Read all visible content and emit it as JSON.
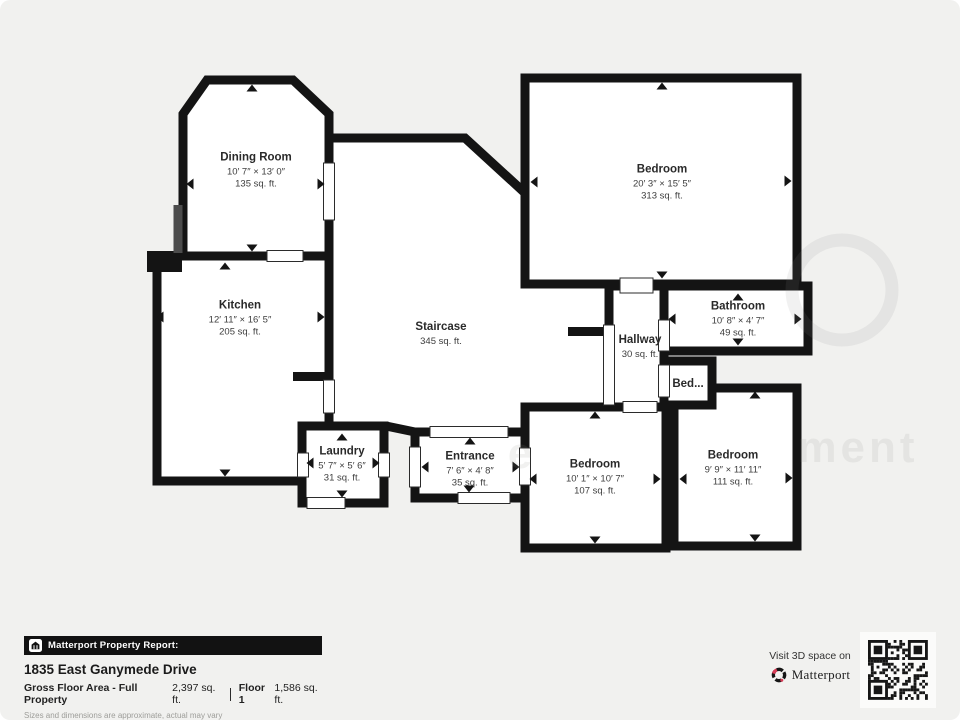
{
  "page": {
    "type": "floor-plan-report",
    "background": "#f1f1ef",
    "wall_color": "#141414",
    "brand_red": "#d63b55"
  },
  "rooms": [
    {
      "id": "dining-room",
      "name": "Dining Room",
      "dimensions": "10′ 7″ × 13′ 0″",
      "area": "135 sq. ft."
    },
    {
      "id": "kitchen",
      "name": "Kitchen",
      "dimensions": "12′ 11″ × 16′ 5″",
      "area": "205 sq. ft."
    },
    {
      "id": "staircase",
      "name": "Staircase",
      "dimensions": "",
      "area": "345 sq. ft."
    },
    {
      "id": "bedroom-master",
      "name": "Bedroom",
      "dimensions": "20′ 3″ × 15′ 5″",
      "area": "313 sq. ft."
    },
    {
      "id": "bathroom",
      "name": "Bathroom",
      "dimensions": "10′ 8″ × 4′ 7″",
      "area": "49 sq. ft."
    },
    {
      "id": "hallway",
      "name": "Hallway",
      "dimensions": "",
      "area": "30 sq. ft."
    },
    {
      "id": "bed-closet",
      "name": "Bed...",
      "dimensions": "",
      "area": ""
    },
    {
      "id": "laundry",
      "name": "Laundry",
      "dimensions": "5′ 7″ × 5′ 6″",
      "area": "31 sq. ft."
    },
    {
      "id": "entrance",
      "name": "Entrance",
      "dimensions": "7′ 6″ × 4′ 8″",
      "area": "35 sq. ft."
    },
    {
      "id": "bedroom-middle",
      "name": "Bedroom",
      "dimensions": "10′ 1″ × 10′ 7″",
      "area": "107 sq. ft."
    },
    {
      "id": "bedroom-right",
      "name": "Bedroom",
      "dimensions": "9′ 9″ × 11′ 11″",
      "area": "111 sq. ft."
    }
  ],
  "report": {
    "banner_title": "Matterport Property Report:",
    "address": "1835 East Ganymede Drive",
    "gross_label": "Gross Floor Area - Full Property",
    "gross_value": "2,397 sq. ft.",
    "floor_label": "Floor 1",
    "floor_value": "1,586 sq. ft.",
    "disclaimer": "Sizes and dimensions are approximate, actual may vary"
  },
  "cta": {
    "visit_text": "Visit 3D space on",
    "brand": "Matterport"
  },
  "watermark": {
    "fragments": [
      "e",
      "ment"
    ]
  }
}
